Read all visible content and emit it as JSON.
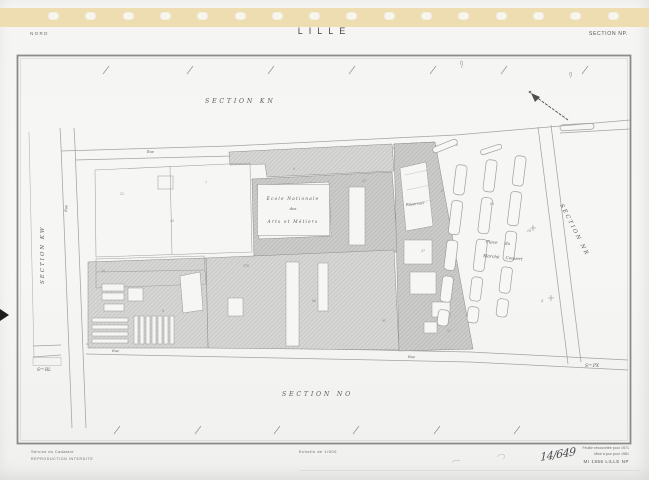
{
  "header": {
    "region": "NORD",
    "city": "LILLE",
    "section": "SECTION NP."
  },
  "map": {
    "sections": {
      "top": "SECTION  KN",
      "left": "SECTION  KW",
      "right": "SECTION  NR",
      "bottom": "SECTION  NO",
      "corner_bottom_left": "Sᵒⁿ RL",
      "corner_bottom_right": "Sᵒⁿ PX"
    },
    "building_label": {
      "line1": "École Nationale",
      "line2": "des",
      "line3": "Arts et Métiers"
    },
    "place_label": {
      "line1": "Place  du",
      "line2": "Marché  Couvert"
    },
    "reservoir_label": "Réservoir",
    "street_labels": {
      "top": "Rue",
      "bottom": "Rue",
      "left": "Rue",
      "bottom_right": "Rue"
    },
    "parcel_numbers": [
      {
        "n": "12",
        "x": 120,
        "y": 195
      },
      {
        "n": "7",
        "x": 205,
        "y": 184
      },
      {
        "n": "9",
        "x": 293,
        "y": 170
      },
      {
        "n": "21",
        "x": 362,
        "y": 182
      },
      {
        "n": "45",
        "x": 170,
        "y": 222
      },
      {
        "n": "118",
        "x": 243,
        "y": 267
      },
      {
        "n": "86",
        "x": 312,
        "y": 302
      },
      {
        "n": "37",
        "x": 421,
        "y": 252
      },
      {
        "n": "5",
        "x": 441,
        "y": 192
      },
      {
        "n": "63",
        "x": 490,
        "y": 205
      },
      {
        "n": "18",
        "x": 527,
        "y": 232
      },
      {
        "n": "8",
        "x": 162,
        "y": 312
      },
      {
        "n": "26",
        "x": 101,
        "y": 272
      },
      {
        "n": "52",
        "x": 447,
        "y": 332
      },
      {
        "n": "4",
        "x": 541,
        "y": 302
      },
      {
        "n": "91",
        "x": 382,
        "y": 322
      }
    ]
  },
  "footer": {
    "left_line1": "Service du Cadastre",
    "left_line2": "REPRODUCTION INTERDITE",
    "center_scale": "Echelle de 1/500",
    "right_line1": "Feuille renouvelée pour 1971",
    "right_line2": "Mise à jour pour 1981",
    "right_line3": "MI 1866 LILLE NP"
  },
  "annotations": {
    "sheet_number": "14/649"
  },
  "colors": {
    "paper": "#f5f5f3",
    "binding": "#efddb2",
    "building": "#d4d4d2",
    "frame": "#8b8b89",
    "ink": "#5a5a55"
  }
}
